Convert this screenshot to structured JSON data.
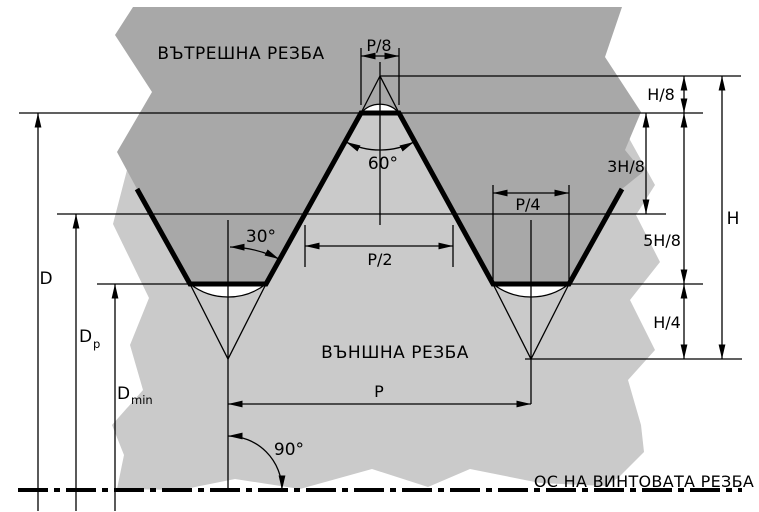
{
  "colors": {
    "internal_region": "#a8a8a8",
    "external_region": "#cacaca",
    "line": "#000000",
    "background": "#ffffff"
  },
  "regions": {
    "internal_label": "ВЪТРЕШНА РЕЗБА",
    "external_label": "ВЪНШНА РЕЗБА",
    "axis_label": "ОС НА ВИНТОВАТА РЕЗБА"
  },
  "dimensions": {
    "pitch_eighth": "P/8",
    "pitch_half": "P/2",
    "pitch_quarter": "P/4",
    "pitch": "P",
    "h_eighth": "H/8",
    "h_three_eighths": "3H/8",
    "h_five_eighths": "5H/8",
    "h_quarter": "H/4",
    "h_full": "H",
    "major_diameter": "D",
    "pitch_diameter_main": "D",
    "pitch_diameter_sub": "p",
    "minor_diameter_main": "D",
    "minor_diameter_sub": "min"
  },
  "angles": {
    "half_profile": "30°",
    "profile": "60°",
    "axis_perpendicular": "90°"
  }
}
